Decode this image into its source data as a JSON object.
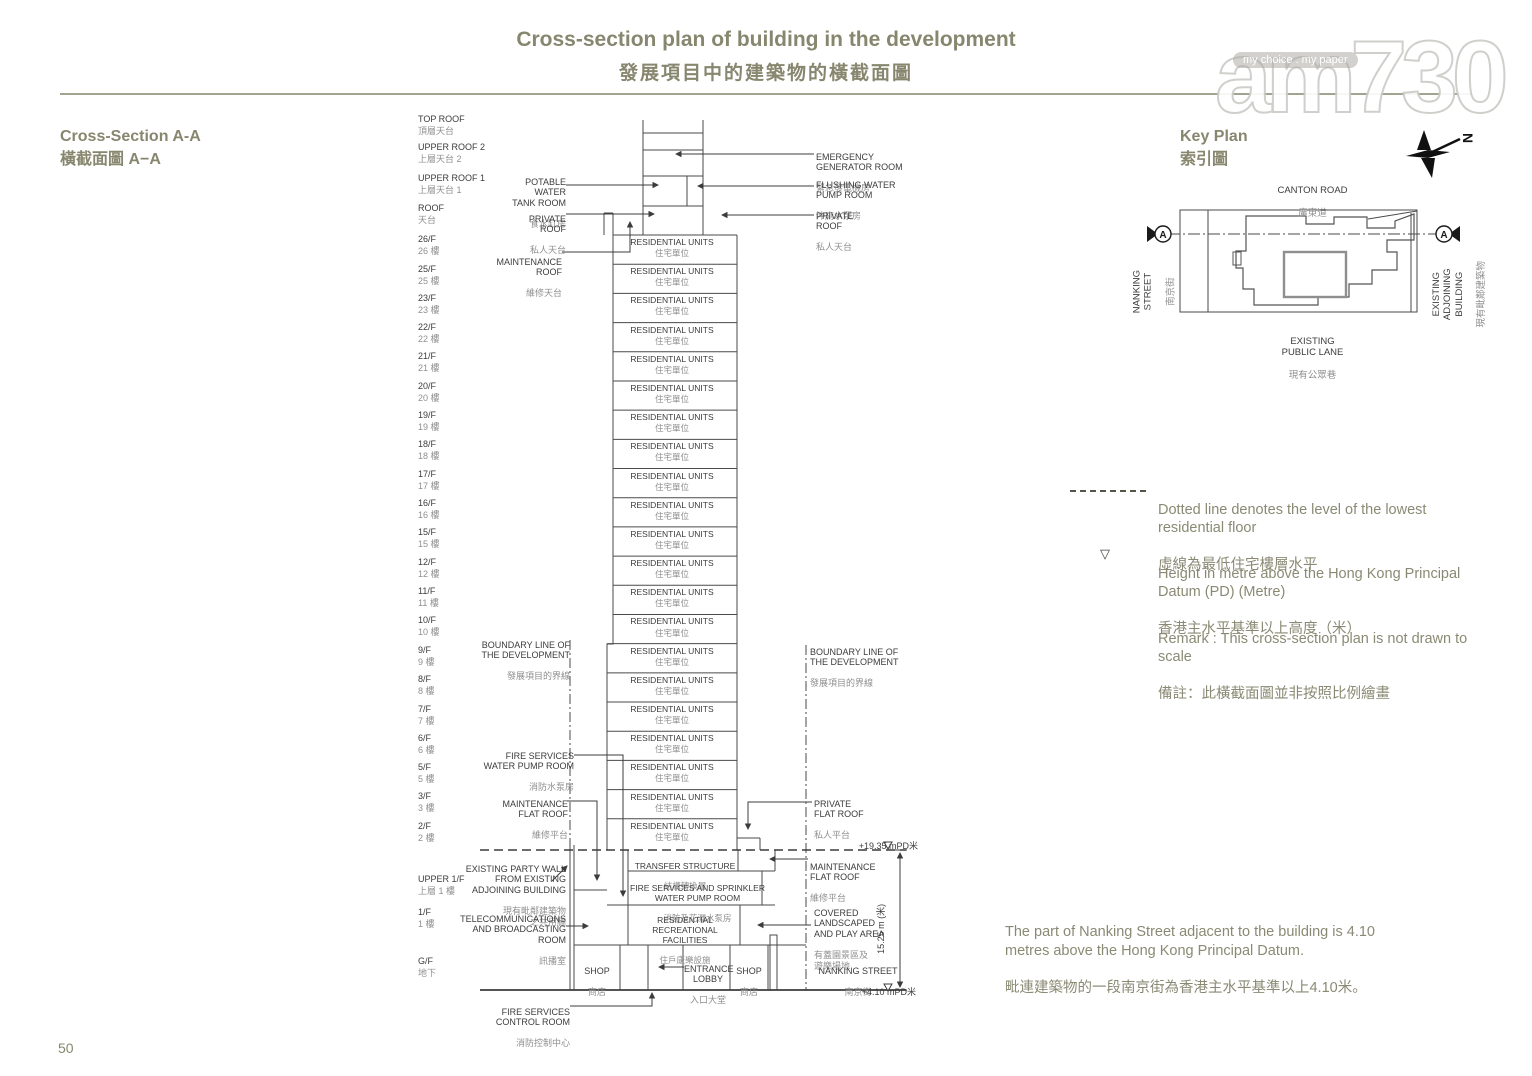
{
  "page": {
    "number": "50"
  },
  "title": {
    "en": "Cross-section plan of building in the development",
    "zh": "發展項目中的建築物的橫截面圖"
  },
  "watermark": {
    "logo": "am730",
    "tagline": "my choice . my paper"
  },
  "cross_section": {
    "heading_en": "Cross-Section A-A",
    "heading_zh": "橫截面圖 A−A",
    "floors": [
      {
        "en": "TOP ROOF",
        "zh": "頂層天台"
      },
      {
        "en": "UPPER ROOF 2",
        "zh": "上層天台 2"
      },
      {
        "en": "UPPER ROOF 1",
        "zh": "上層天台 1"
      },
      {
        "en": "ROOF",
        "zh": "天台"
      },
      {
        "en": "26/F",
        "zh": "26 樓"
      },
      {
        "en": "25/F",
        "zh": "25 樓"
      },
      {
        "en": "23/F",
        "zh": "23 樓"
      },
      {
        "en": "22/F",
        "zh": "22 樓"
      },
      {
        "en": "21/F",
        "zh": "21 樓"
      },
      {
        "en": "20/F",
        "zh": "20 樓"
      },
      {
        "en": "19/F",
        "zh": "19 樓"
      },
      {
        "en": "18/F",
        "zh": "18 樓"
      },
      {
        "en": "17/F",
        "zh": "17 樓"
      },
      {
        "en": "16/F",
        "zh": "16 樓"
      },
      {
        "en": "15/F",
        "zh": "15 樓"
      },
      {
        "en": "12/F",
        "zh": "12 樓"
      },
      {
        "en": "11/F",
        "zh": "11 樓"
      },
      {
        "en": "10/F",
        "zh": "10 樓"
      },
      {
        "en": "9/F",
        "zh": "9 樓"
      },
      {
        "en": "8/F",
        "zh": "8 樓"
      },
      {
        "en": "7/F",
        "zh": "7 樓"
      },
      {
        "en": "6/F",
        "zh": "6 樓"
      },
      {
        "en": "5/F",
        "zh": "5 樓"
      },
      {
        "en": "3/F",
        "zh": "3 樓"
      },
      {
        "en": "2/F",
        "zh": "2 樓"
      },
      {
        "en": "UPPER 1/F",
        "zh": "上層 1 樓"
      },
      {
        "en": "1/F",
        "zh": "1 樓"
      },
      {
        "en": "G/F",
        "zh": "地下"
      }
    ],
    "unit_label": {
      "en": "RESIDENTIAL UNITS",
      "zh": "住宅單位"
    },
    "unit_floor_count": 21,
    "callouts": {
      "potable_water": {
        "en": "POTABLE\nWATER\nTANK ROOM",
        "zh": "食水缸房"
      },
      "private_roof_left": {
        "en": "PRIVATE\nROOF",
        "zh": "私人天台"
      },
      "maintenance_roof": {
        "en": "MAINTENANCE\nROOF",
        "zh": "維修天台"
      },
      "boundary_left": {
        "en": "BOUNDARY LINE OF\nTHE DEVELOPMENT",
        "zh": "發展項目的界線"
      },
      "fire_services_pump": {
        "en": "FIRE SERVICES\nWATER PUMP ROOM",
        "zh": "消防水泵房"
      },
      "maintenance_flat_roof_left": {
        "en": "MAINTENANCE\nFLAT ROOF",
        "zh": "維修平台"
      },
      "party_wall": {
        "en": "EXISTING PARTY WALL\nFROM EXISTING\nADJOINING BUILDING",
        "zh": "現有毗鄰建築物\n之共用牆"
      },
      "telecom": {
        "en": "TELECOMMUNICATIONS\nAND BROADCASTING\nROOM",
        "zh": "訊播室"
      },
      "fire_control": {
        "en": "FIRE SERVICES\nCONTROL ROOM",
        "zh": "消防控制中心"
      },
      "emergency_generator": {
        "en": "EMERGENCY\nGENERATOR ROOM",
        "zh": "緊急發電機房"
      },
      "flushing_water": {
        "en": "FLUSHING WATER\nPUMP ROOM",
        "zh": "沖廁水泵房"
      },
      "private_roof_right": {
        "en": "PRIVATE\nROOF",
        "zh": "私人天台"
      },
      "boundary_right": {
        "en": "BOUNDARY LINE OF\nTHE DEVELOPMENT",
        "zh": "發展項目的界線"
      },
      "private_flat_roof": {
        "en": "PRIVATE\nFLAT ROOF",
        "zh": "私人平台"
      },
      "maintenance_flat_roof_right": {
        "en": "MAINTENANCE\nFLAT ROOF",
        "zh": "維修平台"
      },
      "covered_landscaped": {
        "en": "COVERED\nLANDSCAPED\nAND PLAY AREA",
        "zh": "有蓋園景區及\n遊樂場地"
      },
      "nanking_street": {
        "en": "NANKING STREET",
        "zh": "南京街"
      },
      "transfer_structure": {
        "en": "TRANSFER STRUCTURE",
        "zh": "結構轉換層"
      },
      "sprinkler_pump": {
        "en": "FIRE SERVICES AND SPRINKLER\nWATER PUMP ROOM",
        "zh": "消防及花灑水泵房"
      },
      "recreational": {
        "en": "RESIDENTIAL\nRECREATIONAL\nFACILITIES",
        "zh": "住戶康樂設施"
      },
      "shop": {
        "en": "SHOP",
        "zh": "商店"
      },
      "entrance_lobby": {
        "en": "ENTRANCE\nLOBBY",
        "zh": "入口大堂"
      }
    },
    "levels": {
      "top": "+19.35 mPD米",
      "bottom": "+4.10 mPD米",
      "dimension": "15.25 m (米)"
    }
  },
  "key_plan": {
    "heading_en": "Key Plan",
    "heading_zh": "索引圖",
    "canton_road": {
      "en": "CANTON ROAD",
      "zh": "廣東道"
    },
    "nanking_street": {
      "en": "NANKING\nSTREET",
      "zh": "南京街"
    },
    "existing_adjoining_building": {
      "en": "EXISTING\nADJOINING\nBUILDING",
      "zh": "現有毗鄰建築物"
    },
    "existing_public_lane": {
      "en": "EXISTING\nPUBLIC LANE",
      "zh": "現有公眾巷"
    },
    "section_marker": "A",
    "north": "N"
  },
  "legend": {
    "dotted": {
      "en": "Dotted line denotes the level of the lowest residential floor",
      "zh": "虛線為最低住宅樓層水平"
    },
    "height": {
      "en": "Height in metre above the Hong Kong Principal Datum (PD) (Metre)",
      "zh": "香港主水平基準以上高度（米）"
    },
    "remark": {
      "en": "Remark : This cross-section plan is not drawn to scale",
      "zh": "備註：此橫截面圖並非按照比例繪畫"
    }
  },
  "note": {
    "en": "The part of Nanking Street adjacent to the building is 4.10\nmetres above the Hong Kong Principal Datum.",
    "zh": "毗連建築物的一段南京街為香港主水平基準以上4.10米。"
  }
}
